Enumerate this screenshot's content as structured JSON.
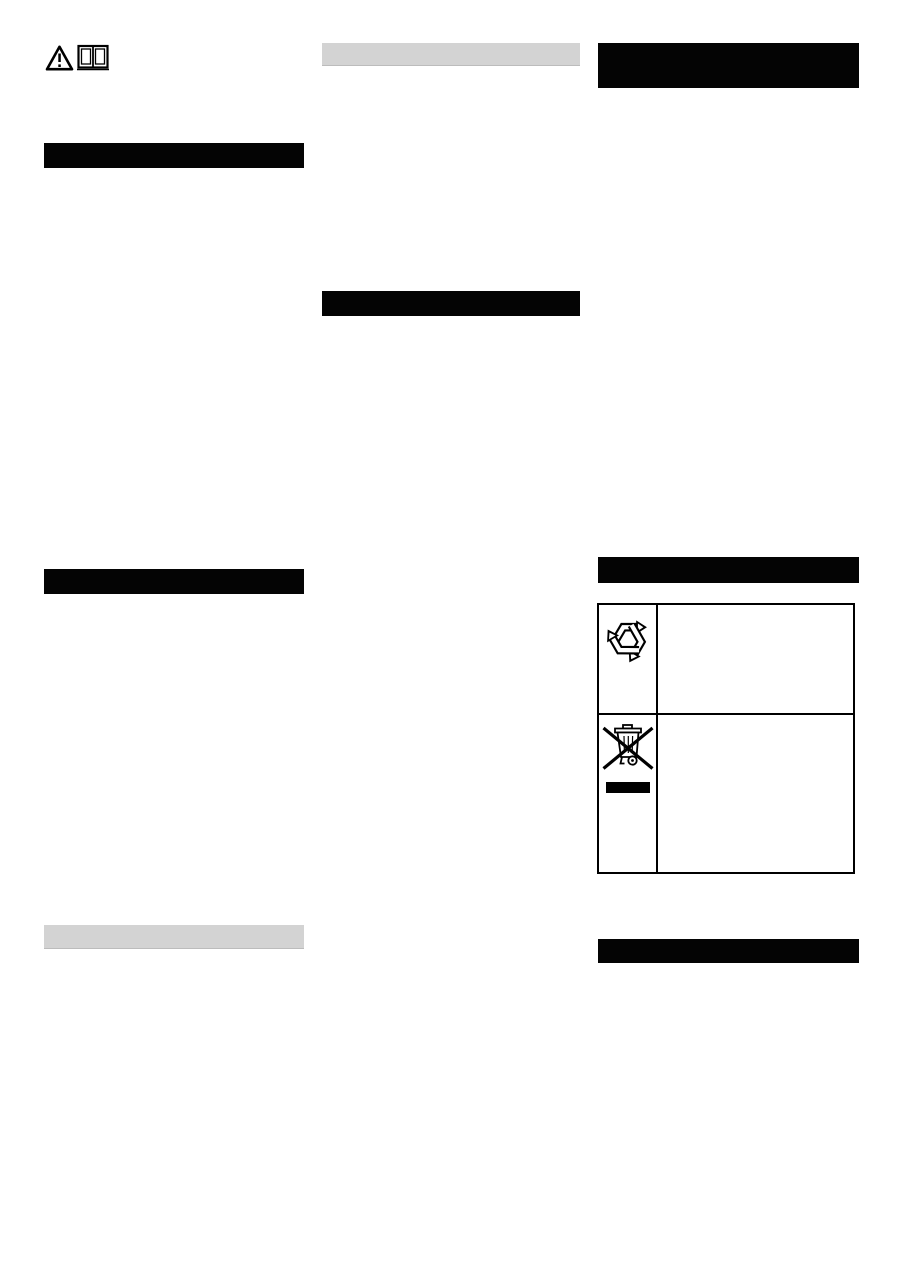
{
  "page": {
    "background": "#ffffff",
    "layout": "three-column manual page, body text blank"
  },
  "palette": {
    "section_bar_black": "#040404",
    "section_bar_gray": "#d3d3d3",
    "table_border": "#000000",
    "icon_ink": "#000000"
  },
  "top_icons": [
    {
      "name": "warning-triangle-icon"
    },
    {
      "name": "open-book-icon"
    }
  ],
  "sections": {
    "left_column": [
      {
        "style": "black",
        "label": ""
      },
      {
        "style": "black",
        "label": ""
      },
      {
        "style": "gray",
        "label": ""
      }
    ],
    "middle_column": [
      {
        "style": "gray",
        "label": ""
      },
      {
        "style": "black",
        "label": ""
      }
    ],
    "right_column": [
      {
        "style": "black",
        "label": ""
      },
      {
        "style": "black",
        "label": ""
      },
      {
        "style": "black",
        "label": ""
      }
    ]
  },
  "disposal_table": {
    "rows": [
      {
        "symbol": "recycling-icon",
        "description": ""
      },
      {
        "symbol": "weee-crossed-out-bin-icon",
        "description": ""
      }
    ]
  }
}
